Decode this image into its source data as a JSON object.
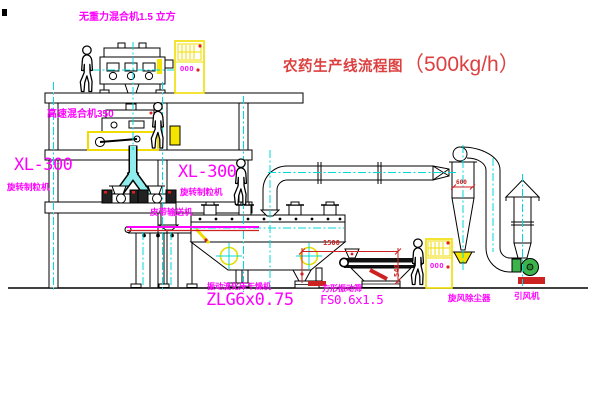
{
  "title": {
    "text": "农药生产线流程图",
    "capacity": "（500kg/h）"
  },
  "labels": {
    "gravity_mixer": "无重力混合机1.5 立方",
    "high_speed_mixer": "高速混合机350",
    "granulator_left_model": "XL-300",
    "granulator_left_name": "旋转制粒机",
    "granulator_right_model": "XL-300",
    "granulator_right_name": "旋转制粒机",
    "belt_conveyor": "皮带输送机",
    "dryer_name": "振动流化床干燥机",
    "dryer_model": "ZLG6x0.75",
    "sieve_name": "方形振动筛",
    "sieve_model": "FS0.6x1.5",
    "cyclone": "旋风除尘器",
    "fan": "引风机"
  },
  "dimensions": {
    "sieve_length": "1500",
    "sieve_height": "548",
    "cyclone_width": "600"
  },
  "control_panels": {
    "panel_top_display": "000",
    "panel_bottom_display": "000"
  },
  "colors": {
    "label_magenta": "#ff00ff",
    "title_red": "#dd4040",
    "dimension_red": "#cc2222",
    "centerline_cyan": "#00d9d9",
    "cabinet_yellow": "#f0dc00",
    "fan_green": "#3cb44b",
    "line_black": "#000000",
    "background": "#ffffff"
  }
}
